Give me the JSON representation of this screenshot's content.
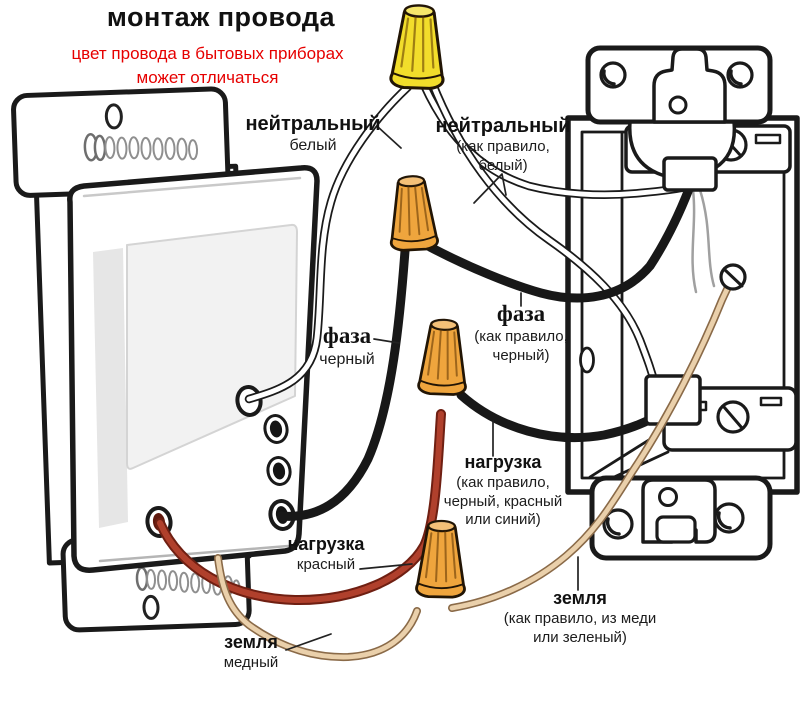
{
  "title": "монтаж провода",
  "subtitle": {
    "line1": "цвет провода в бытовых приборах",
    "line2": "может отличаться"
  },
  "labels": {
    "neutral_left": {
      "title": "нейтральный",
      "sub": "белый"
    },
    "neutral_right": {
      "title": "нейтральный",
      "sub1": "(как правило,",
      "sub2": "белый)"
    },
    "phase_left": {
      "title": "фаза",
      "sub": "черный"
    },
    "phase_right": {
      "title": "фаза",
      "sub1": "(как правило,",
      "sub2": "черный)"
    },
    "load_left": {
      "title": "нагрузка",
      "sub": "красный"
    },
    "load_right": {
      "title": "нагрузка",
      "sub1": "(как правило,",
      "sub2": "черный, красный",
      "sub3": "или синий)"
    },
    "ground_left": {
      "title": "земля",
      "sub": "медный"
    },
    "ground_right": {
      "title": "земля",
      "sub1": "(как правило, из меди",
      "sub2": "или зеленый)"
    }
  },
  "colors": {
    "accent_red_text": "#e60000",
    "line_art": "#1a1a1a",
    "wire_black": "#181818",
    "wire_white": "#ffffff",
    "wire_red": "#b0402c",
    "wire_copper": "#ead0ab",
    "nut_yellow": "#f2dd2b",
    "nut_orange": "#efa53d"
  },
  "icons": [
    "wire-nut-yellow-icon",
    "wire-nut-orange-1-icon",
    "wire-nut-orange-2-icon",
    "wire-nut-orange-3-icon",
    "ground-screw-icon",
    "clamp-screw-top-icon",
    "clamp-screw-bottom-icon",
    "mounting-spring-screw-top-icon",
    "mounting-spring-screw-bottom-icon"
  ]
}
